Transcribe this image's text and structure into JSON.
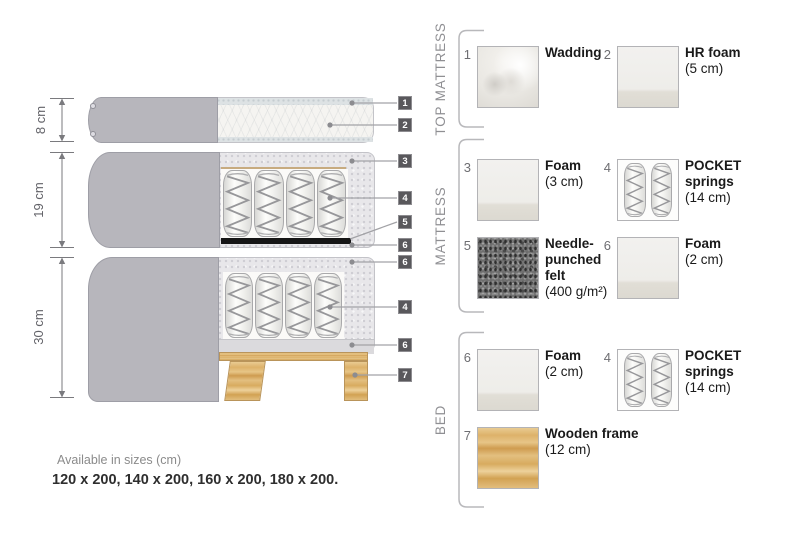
{
  "diagram": {
    "dimensions": [
      {
        "label": "8 cm"
      },
      {
        "label": "19 cm"
      },
      {
        "label": "30 cm"
      }
    ],
    "tags": [
      {
        "n": "1"
      },
      {
        "n": "2"
      },
      {
        "n": "3"
      },
      {
        "n": "4"
      },
      {
        "n": "5"
      },
      {
        "n": "6"
      },
      {
        "n": "6"
      },
      {
        "n": "4"
      },
      {
        "n": "6"
      },
      {
        "n": "7"
      }
    ]
  },
  "legend": {
    "sections": [
      {
        "label": "TOP MATTRESS",
        "items": [
          {
            "num": "1",
            "name": "Wadding",
            "spec": ""
          },
          {
            "num": "2",
            "name": "HR foam",
            "spec": "(5 cm)"
          }
        ]
      },
      {
        "label": "MATTRESS",
        "items": [
          {
            "num": "3",
            "name": "Foam",
            "spec": "(3 cm)"
          },
          {
            "num": "4",
            "name": "POCKET springs",
            "spec": "(14 cm)"
          },
          {
            "num": "5",
            "name": "Needle-punched felt",
            "spec": "(400 g/m²)"
          },
          {
            "num": "6",
            "name": "Foam",
            "spec": "(2 cm)"
          }
        ]
      },
      {
        "label": "BED",
        "items": [
          {
            "num": "6",
            "name": "Foam",
            "spec": "(2 cm)"
          },
          {
            "num": "4",
            "name": "POCKET springs",
            "spec": "(14 cm)"
          },
          {
            "num": "7",
            "name": "Wooden frame",
            "spec": "(12 cm)"
          }
        ]
      }
    ]
  },
  "footer": {
    "sizes_title": "Available in sizes (cm)",
    "sizes_list": "120 x 200, 140 x 200, 160 x 200, 180 x 200."
  },
  "colors": {
    "cover_gray": "#b7b6bc",
    "tag_bg": "#59585c",
    "wood": "#ddb26a",
    "felt": "#3a3a3a",
    "accent_text": "#1a1a1a"
  }
}
